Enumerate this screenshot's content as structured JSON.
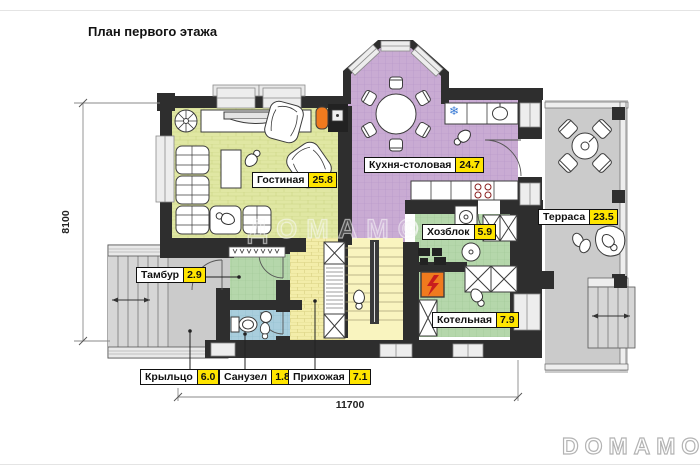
{
  "title": "План первого этажа",
  "dimensions": {
    "horizontal": "11700",
    "vertical": "8100"
  },
  "rooms": [
    {
      "name": "Гостиная",
      "area": "25.8"
    },
    {
      "name": "Кухня-столовая",
      "area": "24.7"
    },
    {
      "name": "Терраса",
      "area": "23.5"
    },
    {
      "name": "Хозблок",
      "area": "5.9"
    },
    {
      "name": "Котельная",
      "area": "7.9"
    },
    {
      "name": "Тамбур",
      "area": "2.9"
    },
    {
      "name": "Санузел",
      "area": "1.8"
    },
    {
      "name": "Прихожая",
      "area": "7.1"
    },
    {
      "name": "Крыльцо",
      "area": "6.0"
    }
  ],
  "watermark": {
    "center": "ДОМАМО",
    "copyright": "©",
    "corner": "DOMAMO"
  },
  "icons": {
    "snowflake": "❄"
  },
  "colors": {
    "wall": "#2e2e2e",
    "label_area_bg": "#ffe500",
    "living_floor": "#e0e7a3",
    "kitchen_floor": "#c9abd3",
    "utility_floor": "#b5d7ab",
    "bath_floor": "#a9cedd",
    "hall_floor": "#f3eda9",
    "outdoor_floor": "#cbcbcb",
    "fireplace_orange": "#f07a1e"
  }
}
